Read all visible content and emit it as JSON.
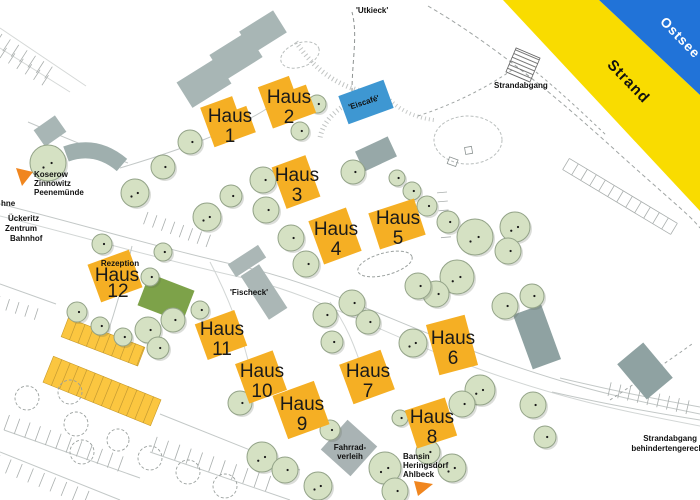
{
  "houses": [
    {
      "name": "Haus",
      "number": "1"
    },
    {
      "name": "Haus",
      "number": "2"
    },
    {
      "name": "Haus",
      "number": "3"
    },
    {
      "name": "Haus",
      "number": "4"
    },
    {
      "name": "Haus",
      "number": "5"
    },
    {
      "name": "Haus",
      "number": "6"
    },
    {
      "name": "Haus",
      "number": "7"
    },
    {
      "name": "Haus",
      "number": "8"
    },
    {
      "name": "Haus",
      "number": "9"
    },
    {
      "name": "Haus",
      "number": "10"
    },
    {
      "name": "Haus",
      "number": "11"
    },
    {
      "name": "Haus",
      "number": "12"
    }
  ],
  "labels": {
    "reception": "Rezeption",
    "utkieck": "'Utkieck'",
    "eiscafe": "'Eiscafé'",
    "fischeck": "'Fischeck'",
    "bike_rental_line1": "Fahrrad-",
    "bike_rental_line2": "verleih"
  },
  "beach": {
    "sea": "Ostsee",
    "beach": "Strand",
    "access_top": "Strandabgang",
    "access_accessible_line1": "Strandabgang",
    "access_accessible_line2": "behindertengerecht"
  },
  "directions": {
    "west": [
      "Koserow",
      "Zinnowitz",
      "Peenemünde"
    ],
    "west_edge_fragment": "hne",
    "southwest": [
      "Ückeritz",
      "Zentrum",
      "Bahnhof"
    ],
    "southeast": [
      "Bansin",
      "Heringsdorf",
      "Ahlbeck"
    ]
  },
  "colors": {
    "house": "#F5AF24",
    "sea_band": "#2173D8",
    "beach_band": "#F9DC00",
    "cafe": "#3E97D2",
    "tree": "#D5E1C3",
    "building_grey": "#9FAFAF",
    "sports_field": "#7DA249",
    "parking": "#FBC640",
    "direction_arrow": "#F0861F"
  }
}
